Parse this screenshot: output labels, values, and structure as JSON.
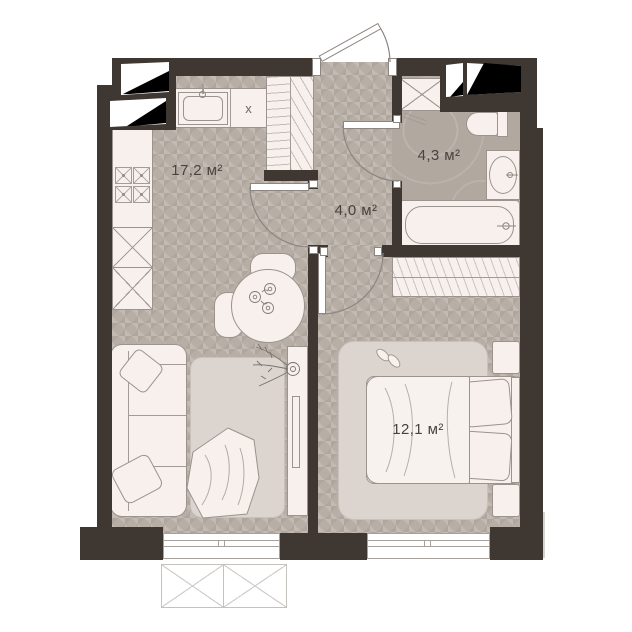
{
  "plan": {
    "type": "apartment-floor-plan",
    "rooms": {
      "living_kitchen": {
        "name": "living-kitchen",
        "area_label": "17,2 м²"
      },
      "hall": {
        "name": "hall",
        "area_label": "4,0 м²"
      },
      "bathroom": {
        "name": "bathroom",
        "area_label": "4,3 м²"
      },
      "bedroom": {
        "name": "bedroom",
        "area_label": "12,1 м²"
      }
    },
    "kitchen": {
      "cabinet_label": "х"
    },
    "colors": {
      "wall": "#3f3732",
      "floor": "#b7aea6",
      "bathroom_floor": "#b1a8a0",
      "furniture_fill": "#f7f0ed",
      "furniture_outline": "#9b938d",
      "rug": "#dcd5cf",
      "vent_shaft": "#000000",
      "label_text": "#4a423d",
      "background": "#ffffff"
    }
  }
}
